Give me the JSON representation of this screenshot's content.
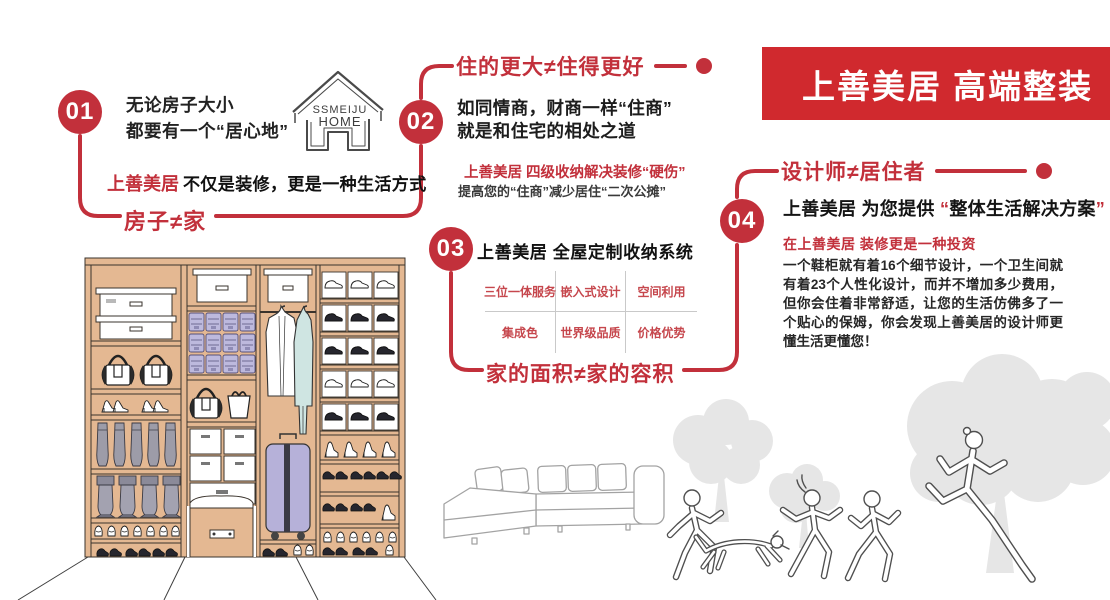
{
  "banner": {
    "title": "上善美居 高端整装"
  },
  "logo": {
    "line1": "SSMEIJU",
    "line2": "HOME"
  },
  "colors": {
    "accent_red": "#c2303b",
    "banner_red": "#d0292e",
    "wood_tan": "#e4b892",
    "bin_lavender": "#bdb9dd",
    "suitcase_lavender": "#b6b1d9",
    "garment_blue": "#cfe5e2",
    "tree_gray": "#e6e6e6"
  },
  "point1": {
    "num": "01",
    "line1": "无论房子大小",
    "line2": "都要有一个“居心地”",
    "tag_brand": "上善美居",
    "tag_rest": "不仅是装修，更是一种生活方式",
    "slogan": "房子≠家"
  },
  "point2": {
    "num": "02",
    "heading": "住的更大≠住得更好",
    "line1": "如同情商，财商一样“住商”",
    "line2": "就是和住宅的相处之道",
    "sub_red": "上善美居 四级收纳解决装修“硬伤”",
    "sub_gray": "提高您的“住商”减少居住“二次公摊”"
  },
  "point3": {
    "num": "03",
    "heading": "上善美居 全屋定制收纳系统",
    "cells": [
      "三位一体服务",
      "嵌入式设计",
      "空间利用",
      "集成色",
      "世界级品质",
      "价格优势"
    ],
    "slogan": "家的面积≠家的容积"
  },
  "point4": {
    "num": "04",
    "heading": "设计师≠居住者",
    "intro_brand": "上善美居",
    "intro_mid": " 为您提供 ",
    "quote_open": "“",
    "intro_quoted": "整体生活解决方案",
    "quote_close": "”",
    "sub_red": "在上善美居 装修更是一种投资",
    "body": "一个鞋柜就有着16个细节设计，一个卫生间就有着23个人性化设计，而并不增加多少费用，但你会住着非常舒适，让您的生活仿佛多了一个贴心的保姆，你会发现上善美居的设计师更懂生活更懂您！"
  }
}
